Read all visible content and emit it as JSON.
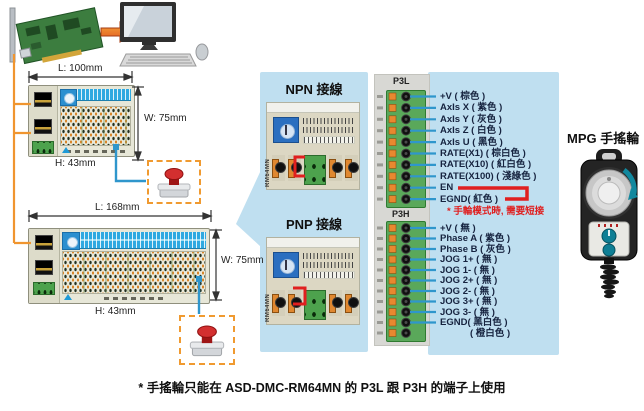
{
  "labels": {
    "npn": "NPN 接線",
    "pnp": "PNP 接線",
    "mpg": "MPG 手搖輪",
    "note_short_circuit": "* 手輪模式時, 需要短接",
    "caption": "* 手搖輪只能在 ASD-DMC-RM64MN 的 P3L 跟 P3H 的端子上使用"
  },
  "dimensions": {
    "module1": {
      "length": "L: 100mm",
      "width": "W: 75mm",
      "height": "H: 43mm"
    },
    "module2": {
      "length": "L: 168mm",
      "width": "W: 75mm",
      "height": "H: 43mm"
    }
  },
  "module_model": "RM64MN",
  "connectors": {
    "p3l": {
      "label": "P3L",
      "pins": [
        "+V ( 棕色 )",
        "AxIs X ( 紫色 )",
        "AxIs Y ( 灰色 )",
        "AxIs Z ( 白色 )",
        "AxIs U ( 黑色 )",
        "RATE(X1) ( 棕白色 )",
        "RATE(X10) ( 紅白色 )",
        "RATE(X100) ( 淺綠色 )",
        "EN",
        "EGND( 紅色 )"
      ]
    },
    "p3h": {
      "label": "P3H",
      "pins": [
        "+V ( 無 )",
        "Phase A ( 紫色 )",
        "Phase B ( 灰色 )",
        "JOG 1+ ( 無 )",
        "JOG 1- ( 無 )",
        "JOG 2+ ( 無 )",
        "JOG 2- ( 無 )",
        "JOG 3+ ( 無 )",
        "JOG 3- ( 無 )",
        "EGND( 黑白色 )",
        "( 橙白色 )"
      ]
    }
  },
  "colors": {
    "panel_blue": "#bfdff0",
    "wire_blue": "#2f96cc",
    "wire_orange": "#f0952f",
    "alert_red": "#e01f1f",
    "connector_green": "#5aa85a",
    "module_header_blue": "#2fa9e0"
  }
}
